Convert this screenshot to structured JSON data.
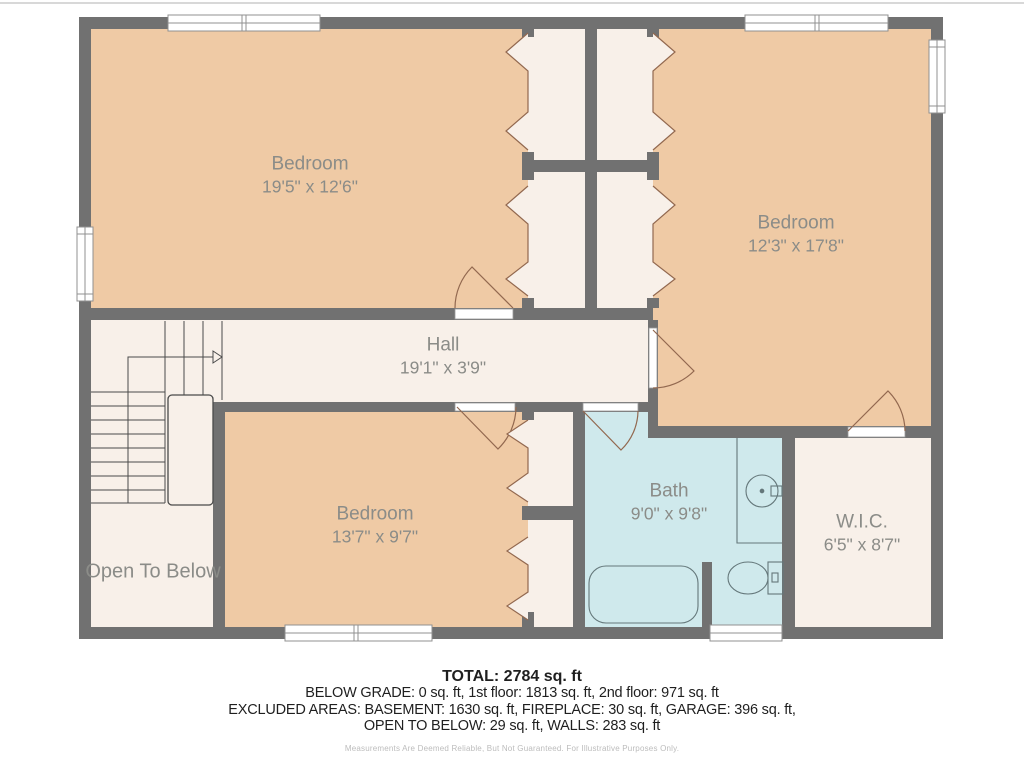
{
  "floor_plan": {
    "type": "second-floor residential floor plan",
    "colors": {
      "wall": "#717171",
      "bedroom_fill": "#EFCAA5",
      "hall_closet_fill": "#F8F0E9",
      "bath_fill": "#CFE9EC",
      "label_text": "#8B8C88",
      "door_stroke": "#92684F",
      "fixture_stroke": "#64777A",
      "stair_stroke": "#4A4A4A",
      "window_stroke": "#909090"
    },
    "rooms": [
      {
        "id": "bedroom-1",
        "name": "Bedroom",
        "dimensions": "19'5\" x 12'6\""
      },
      {
        "id": "bedroom-2",
        "name": "Bedroom",
        "dimensions": "12'3\" x 17'8\""
      },
      {
        "id": "hall",
        "name": "Hall",
        "dimensions": "19'1\" x 3'9\""
      },
      {
        "id": "bedroom-3",
        "name": "Bedroom",
        "dimensions": "13'7\" x 9'7\""
      },
      {
        "id": "bath",
        "name": "Bath",
        "dimensions": "9'0\" x 9'8\""
      },
      {
        "id": "wic",
        "name": "W.I.C.",
        "dimensions": "6'5\" x 8'7\""
      },
      {
        "id": "open-to-below",
        "name": "Open To Below",
        "dimensions": ""
      }
    ],
    "fixtures": [
      "bathtub",
      "toilet",
      "sink",
      "staircase",
      "closet-bifold-doors"
    ]
  },
  "summary": {
    "total": "TOTAL: 2784 sq. ft",
    "line_1": "BELOW GRADE: 0 sq. ft, 1st floor: 1813 sq. ft, 2nd floor: 971 sq. ft",
    "line_2": "EXCLUDED AREAS: BASEMENT: 1630 sq. ft, FIREPLACE: 30 sq. ft, GARAGE: 396 sq. ft,",
    "line_3": "OPEN TO BELOW: 29 sq. ft, WALLS: 283 sq. ft",
    "disclaimer": "Measurements Are Deemed Reliable, But Not Guaranteed. For Illustrative Purposes Only."
  }
}
